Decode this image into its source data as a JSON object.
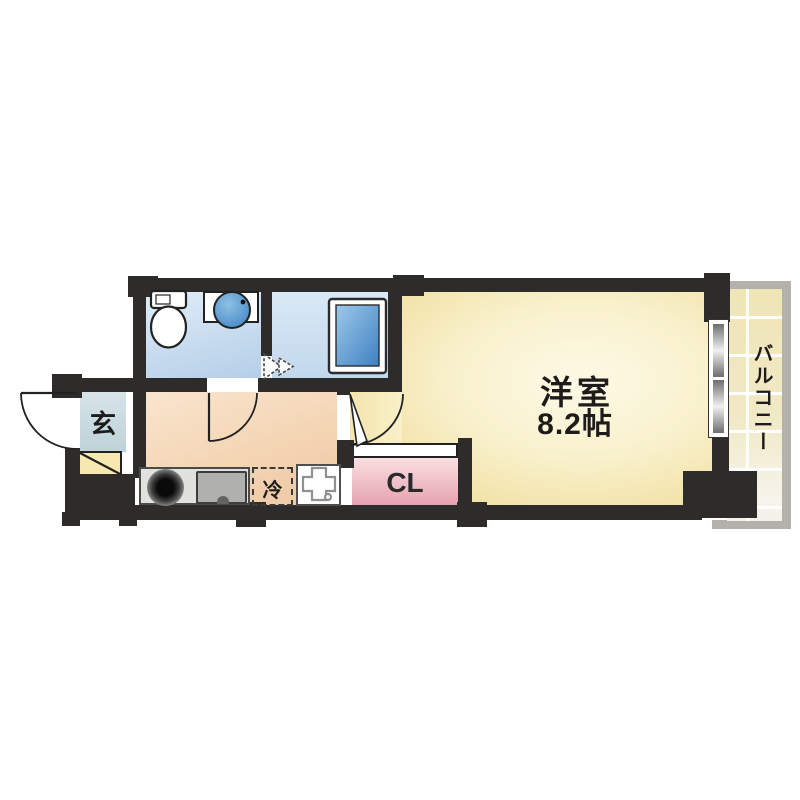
{
  "plan": {
    "main_room": {
      "label": "洋室",
      "size": "8.2帖"
    },
    "balcony": {
      "label": "バルコニー"
    },
    "closet": {
      "label": "CL"
    },
    "entrance": {
      "label": "玄"
    },
    "refrigerator": {
      "label": "冷"
    }
  },
  "colors": {
    "wall": "#2d2c2a",
    "main_room_floor": "#f8efc4",
    "kitchen_floor": "#f3d3ae",
    "wet_area_floor": "#c9dcef",
    "entrance_floor": "#c9dade",
    "closet_fill": "#eba8b2",
    "balcony_tile": "#efe5b6",
    "bathtub_fill": "#5f9fd6",
    "railing": "#b3b1ac"
  }
}
